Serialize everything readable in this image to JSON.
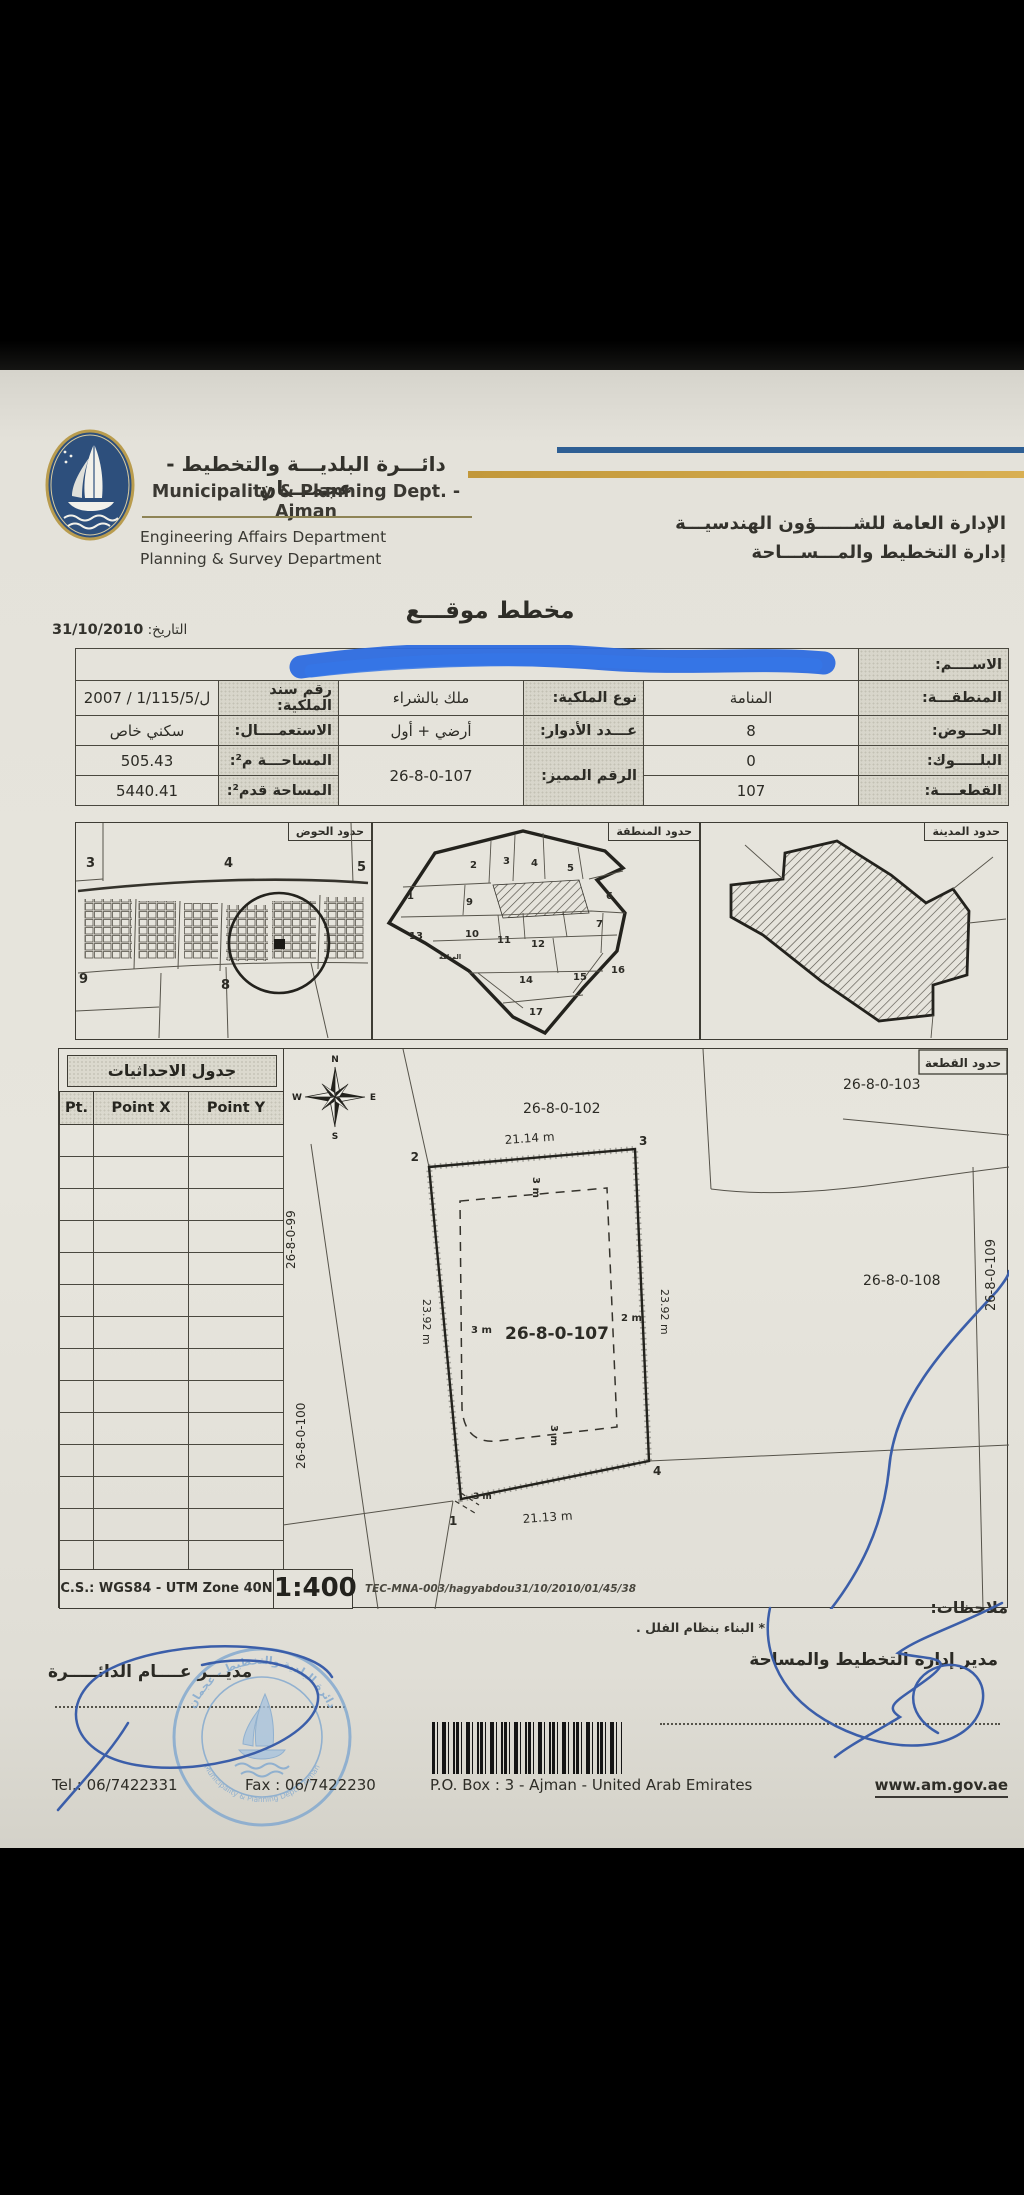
{
  "header": {
    "dept_ar": "دائـــرة البلديـــة والتخطيط - عجمــــان",
    "dept_en": "Municipality & Planning Dept. - Ajman",
    "eng_affairs": "Engineering Affairs Department",
    "planning_survey": "Planning & Survey Department",
    "gen_admin_ar": "الإدارة العامة للشــــــؤون الهندسيـــة",
    "planning_admin_ar": "إدارة التخطيط والمـــســـاحة"
  },
  "titlebar": {
    "title": "مخطط موقـــع",
    "date_label": "التاريخ:",
    "date": "31/10/2010"
  },
  "info": {
    "name_label": "الاســــم:",
    "area_label": "المنطقـــة:",
    "area": "المنامة",
    "ownership_label": "نوع الملكية:",
    "ownership": "ملك بالشراء",
    "deed_label": "رقم سند الملكية:",
    "deed": "2007 / 1/115/5/ل",
    "basin_label": "الحـــوض:",
    "basin": "8",
    "floors_label": "عـــدد الأدوار:",
    "floors": "أرضي + أول",
    "use_label": "الاستعمــــال:",
    "use": "سكني خاص",
    "block_label": "البلـــــوك:",
    "block": "0",
    "unique_label": "الرقم المميز:",
    "unique": "26-8-0-107",
    "area_m2_label": "المساحـــة م²:",
    "area_m2": "505.43",
    "plot_label": "القطعــــة:",
    "plot": "107",
    "area_ft2_label": "المساحة قدم²:",
    "area_ft2": "5440.41"
  },
  "maps": {
    "basin_title": "حدود الحوض",
    "district_title": "حدود المنطقة",
    "city_title": "حدود المدينة",
    "basin": {
      "n3": "3",
      "n4": "4",
      "n5": "5",
      "n9": "9",
      "n8": "8"
    },
    "district": {
      "z1": "1",
      "z2": "2",
      "z3": "3",
      "z4": "4",
      "z5": "5",
      "z6": "6",
      "z7": "7",
      "z9": "9",
      "z10": "10",
      "z11": "11",
      "z12": "12",
      "z13": "13",
      "z14": "14",
      "z15": "15",
      "z16": "16",
      "z17": "17",
      "town": "المنامة"
    }
  },
  "coords": {
    "title": "جدول الاحداثيات",
    "col_pt": "Pt.",
    "col_x": "Point X",
    "col_y": "Point Y",
    "cs": "C.S.: WGS84 - UTM Zone 40N",
    "scale": "1:400",
    "fileref": "TEC-MNA-003/hagyabdou31/10/2010/01/45/38"
  },
  "plan": {
    "title": "حدود القطعة",
    "plot_no": "26-8-0-107",
    "n102": "26-8-0-102",
    "n103": "26-8-0-103",
    "n108": "26-8-0-108",
    "n109": "26-8-0-109",
    "n99": "26-8-0-99",
    "n100": "26-8-0-100",
    "dim_top": "21.14 m",
    "dim_bottom": "21.13 m",
    "dim_left": "23.92 m",
    "dim_right": "23.92 m",
    "p1": "1",
    "p2": "2",
    "p3": "3",
    "p4": "4",
    "sb_left": "3 m",
    "sb_right": "2 m",
    "sb_top": "3 m",
    "sb_bottom": "3 m",
    "sb_corner": "3 m",
    "compass": {
      "n": "N",
      "e": "E",
      "s": "S",
      "w": "W"
    }
  },
  "footer": {
    "notes_label": "ملاحظات:",
    "note": "* البناء بنظام الفلل .",
    "dir_planning": "مدير إدارة التخطيط والمساحة",
    "dir_general": "مديـــر عــــام الدائـــــرة",
    "stamp_ar": "دائرة البلدية والتخطيط - عجمان",
    "stamp_en": "Municipality & Planning Dept. - Ajman",
    "tel": "Tel.: 06/7422331",
    "fax": "Fax : 06/7422230",
    "pobox": "P.O. Box : 3 - Ajman - United Arab Emirates",
    "web": "www.am.gov.ae"
  },
  "colors": {
    "bar_blue": "#2e5f94",
    "bar_gold": "#d2a544",
    "marker_blue": "#2d6ce0",
    "pen_blue": "#3b5ea9",
    "stamp_blue": "#7fa7cf"
  }
}
